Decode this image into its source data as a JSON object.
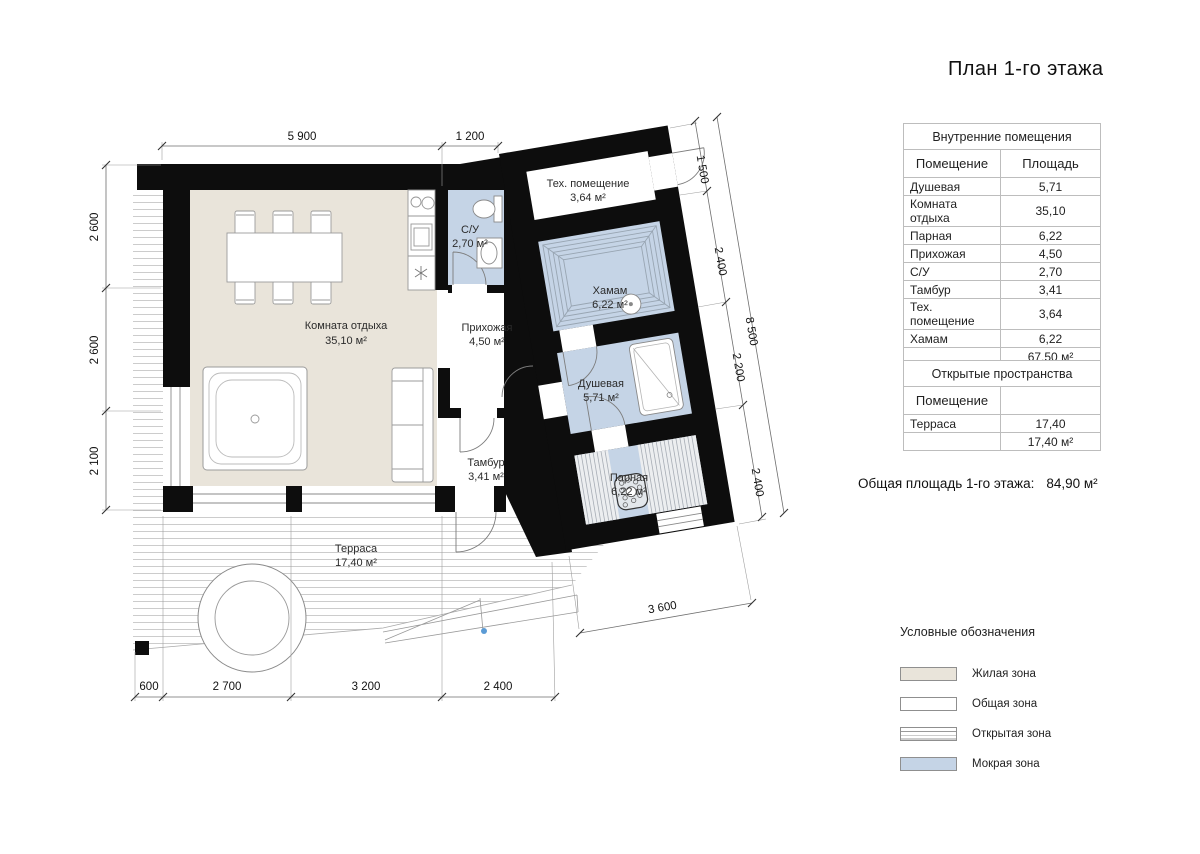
{
  "title": "План 1-го этажа",
  "colors": {
    "wall": "#0d0d0d",
    "living_zone": "#e9e4da",
    "wet_zone": "#c5d4e6",
    "legend_open_zone": "#ffffff",
    "ramp_dot": "#5b9bd5"
  },
  "tables": {
    "internal": {
      "caption": "Внутренние помещения",
      "col_room": "Помещение",
      "col_area": "Площадь",
      "rows": [
        {
          "name": "Душевая",
          "area": "5,71"
        },
        {
          "name": "Комната отдыха",
          "area": "35,10"
        },
        {
          "name": "Парная",
          "area": "6,22"
        },
        {
          "name": "Прихожая",
          "area": "4,50"
        },
        {
          "name": "С/У",
          "area": "2,70"
        },
        {
          "name": "Тамбур",
          "area": "3,41"
        },
        {
          "name": "Тех. помещение",
          "area": "3,64"
        },
        {
          "name": "Хамам",
          "area": "6,22"
        }
      ],
      "total": "67,50 м²"
    },
    "open": {
      "caption": "Открытые пространства",
      "col_room": "Помещение",
      "col_area": "",
      "rows": [
        {
          "name": "Терраса",
          "area": "17,40"
        }
      ],
      "total": "17,40 м²"
    }
  },
  "summary": {
    "label": "Общая площадь 1-го этажа:",
    "value": "84,90 м²"
  },
  "legend": {
    "title": "Условные обозначения",
    "items": [
      {
        "label": "Жилая зона",
        "color": "#e9e4da"
      },
      {
        "label": "Общая зона",
        "color": "#ffffff"
      },
      {
        "label": "Открытая зона",
        "color": "#ffffff"
      },
      {
        "label": "Мокрая зона",
        "color": "#c5d4e6"
      }
    ]
  },
  "plan": {
    "rooms": {
      "lounge": {
        "name": "Комната отдыха",
        "area": "35,10 м²"
      },
      "wc": {
        "name": "С/У",
        "area": "2,70 м²"
      },
      "hallway": {
        "name": "Прихожая",
        "area": "4,50 м²"
      },
      "tambour": {
        "name": "Тамбур",
        "area": "3,41 м²"
      },
      "tech": {
        "name": "Тех. помещение",
        "area": "3,64 м²"
      },
      "hamam": {
        "name": "Хамам",
        "area": "6,22 м²"
      },
      "shower": {
        "name": "Душевая",
        "area": "5,71 м²"
      },
      "steam": {
        "name": "Парная",
        "area": "6,22 м²"
      },
      "terrace": {
        "name": "Терраса",
        "area": "17,40 м²"
      }
    },
    "dims": {
      "top": [
        "5 900",
        "1 200"
      ],
      "left": [
        "2 600",
        "2 600",
        "2 100"
      ],
      "bottom": [
        "600",
        "2 700",
        "3 200",
        "2 400"
      ],
      "right_chain": [
        "1 500",
        "2 400",
        "2 200",
        "2 400"
      ],
      "right_total": "8 500",
      "wing_bottom": "3 600"
    }
  }
}
